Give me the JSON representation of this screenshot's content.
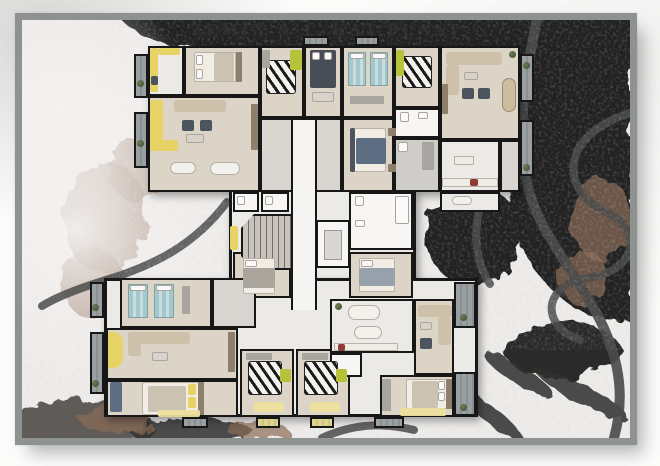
{
  "title": "ZEMİN & 1. KAT PLANI",
  "palette": {
    "frame": "#8e9392",
    "snow": "#efedeb",
    "forest-dark": "#202120",
    "road": "#4a4b4b",
    "tree-brown": "#8c6c57",
    "wall": "#171717",
    "floor-wood": "#dcd4c6",
    "floor-tile": "#eceae6",
    "floor-stone": "#cfcdc9",
    "corridor": "#f5f4f2",
    "accent-yellow": "#e7d365",
    "accent-green": "#b5c23a",
    "accent-teal": "#a3c7ca",
    "sofa-beige": "#cec1aa",
    "dark-furn": "#4c545e",
    "balcony": "#9aa0a1",
    "plant": "#3c4a30",
    "rug-yellow": "#ecdf9d"
  }
}
